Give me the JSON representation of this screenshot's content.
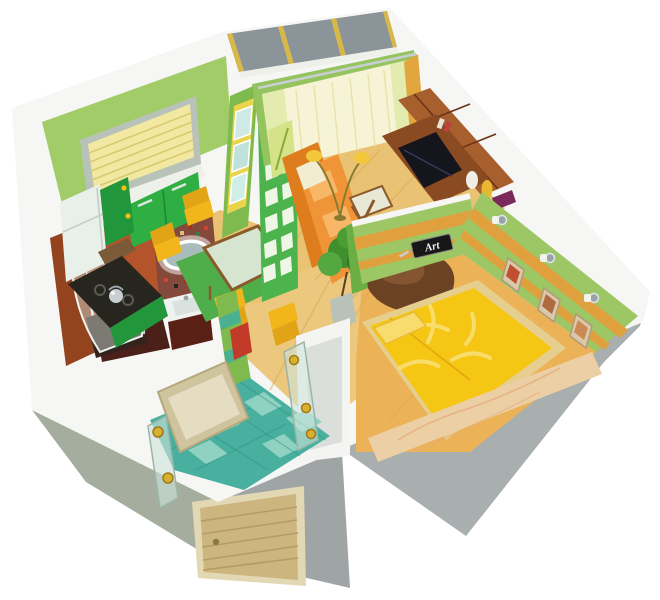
{
  "scene": {
    "type": "3d-apartment-floorplan-cutaway",
    "rooms": [
      "kitchen",
      "living-room",
      "bedroom",
      "bathroom",
      "hallway",
      "balcony",
      "entrance"
    ]
  },
  "art_sign": {
    "label": "Art"
  },
  "colors": {
    "shell_white": "#f6f6f4",
    "face_gray": "#a9aeae",
    "face_gray_dark": "#9fa4a4",
    "face_green_gray": "#a4ad9e",
    "door_wood": "#cdb57f",
    "door_frame": "#e2d8b4",
    "balcony_glass": "#8b9499",
    "balcony_gold": "#d9b84a",
    "kitchen_wall": "#a2cc68",
    "kitchen_wall_deep": "#7fba4e",
    "blinds_yellow": "#f2e8a2",
    "window_frame": "#b9c2b8",
    "sill_white": "#eef0ea",
    "cabinet_green": "#2fae44",
    "cabinet_green_dark": "#22963a",
    "fridge_white": "#e9efe9",
    "counter_dark": "#26261f",
    "chair_yellow": "#f2b51c",
    "chair_yellow_deep": "#e0a416",
    "table_glass": "#d6e5d0",
    "table_frame": "#8a5a2a",
    "rug_green": "#4fae4a",
    "wood_floor": "#e9c273",
    "wood_floor_deep": "#d8a855",
    "corridor_floor": "#ecc77e",
    "lr_wall": "#95c45e",
    "curtain_cream": "#f7f3d6",
    "curtain_gold": "#e2a63e",
    "sofa_orange": "#f09438",
    "sofa_orange_deep": "#dd7d1e",
    "cushion_cream": "#f2ecd2",
    "lamp_yellow": "#f2c73c",
    "fur_rug": "#6b4223",
    "plant_green": "#3f8f2f",
    "pot_gray": "#b9c2b9",
    "unit_brown": "#a75f2e",
    "unit_brown_deep": "#8a4a22",
    "tv_screen": "#15151d",
    "vase_white": "#f0ede4",
    "vase_yellow": "#e8b830",
    "bedroom_wall": "#9dc765",
    "stripe_orange": "#e0a03e",
    "bed_yellow": "#f6c614",
    "bed_leaf": "#f9dd6a",
    "bed_border": "#e6cf8e",
    "headboard_wood": "#eccfa4",
    "bedroom_floor": "#ecb257",
    "bath_wall": "#b5532a",
    "bath_wall_deep": "#93431e",
    "bath_floor": "#4a2018",
    "mirror_glass": "#a8bcbc",
    "sink_white": "#eef2f0",
    "vanity_dark": "#5a2016",
    "towel_red": "#c43122",
    "shower_tray": "#33231d",
    "tile_teal": "#49b0a0",
    "tile_teal_light": "#8fd2c2",
    "hall_mirror": "#cfc49e",
    "hall_mirror_inner": "#e4ddc2",
    "screen_green": "#4db34d",
    "panel_yellow": "#e9d44c",
    "sign_black": "#171717",
    "sign_text": "#f2f2f2",
    "chrome": "#c9ced2",
    "bath_ext_wall": "#7fba4e",
    "red_object": "#c23a28",
    "glass_door": "#cfe4da",
    "gold_fitting": "#d8b030"
  }
}
